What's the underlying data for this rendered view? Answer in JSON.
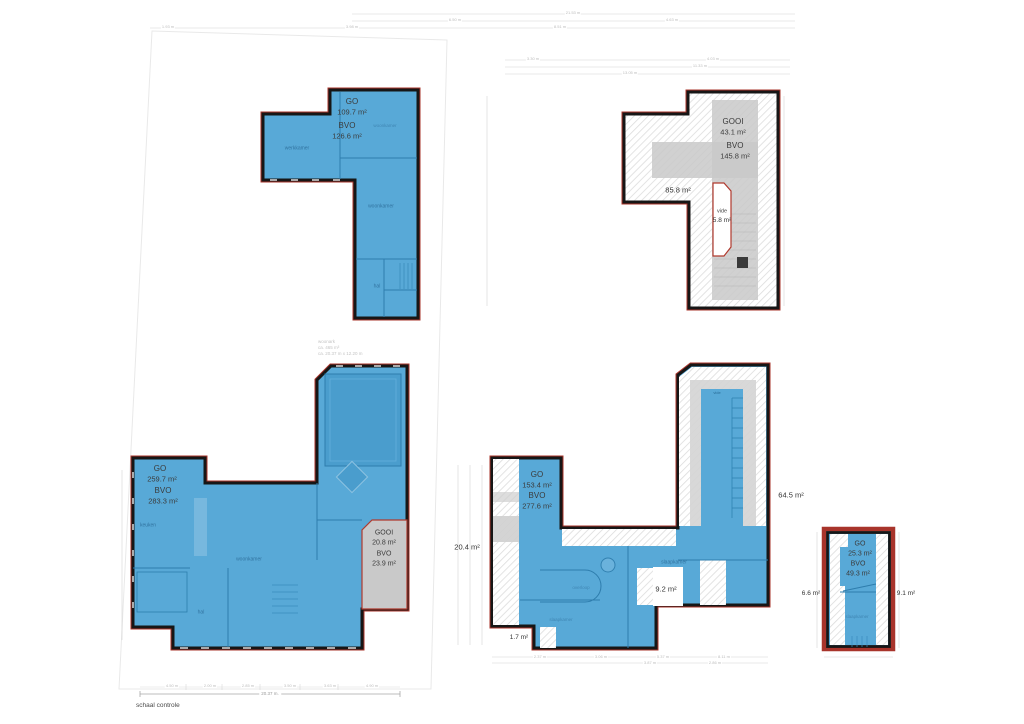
{
  "plans": {
    "p1": {
      "go_label": "GO",
      "go": "109.7 m²",
      "bvo_label": "BVO",
      "bvo": "126.6 m²",
      "rooms": {
        "werkkamer": "werkkamer",
        "woonkamer_top": "woonkamer",
        "woonkamer": "woonkamer",
        "hal": "hal"
      }
    },
    "p2": {
      "gooi_label": "GOOI",
      "gooi": "43.1 m²",
      "bvo_label": "BVO",
      "bvo": "145.8 m²",
      "area": "85.8 m²",
      "vide_label": "vide",
      "vide": "5.8 m²"
    },
    "p3": {
      "go_label": "GO",
      "go": "259.7 m²",
      "bvo_label": "BVO",
      "bvo": "283.3 m²",
      "gooi_label": "GOOI",
      "gooi": "20.8 m²",
      "gooi_bvo_label": "BVO",
      "gooi_bvo": "23.9 m²",
      "rooms": {
        "keuken": "keuken",
        "woonkamer": "woonkamer",
        "hal": "hal"
      },
      "notes": {
        "l1": "woonark",
        "l2": "ca. 465 m³",
        "l3": "ca. 20.37 m x 12.20 m"
      }
    },
    "p4": {
      "go_label": "GO",
      "go": "153.4 m²",
      "bvo_label": "BVO",
      "bvo": "277.6 m²",
      "area_left": "20.4 m²",
      "area_right": "64.5 m²",
      "area_notch": "9.2 m²",
      "area_bottom": "1.7 m²",
      "rooms": {
        "slaapkamer_r": "slaapkamer",
        "overloop": "overloop",
        "slaapkamer_l": "slaapkamer",
        "vide": "vide"
      }
    },
    "p5": {
      "go_label": "GO",
      "go": "25.3 m²",
      "bvo_label": "BVO",
      "bvo": "49.3 m²",
      "area_left": "6.6 m²",
      "area_right": "9.1 m²",
      "room": "slaapkamer"
    }
  },
  "dims": {
    "d0": "21.53 m",
    "d1": "6.50 m",
    "d2": "4.63 m",
    "d3": "1.93 m",
    "d4": "3.98 m",
    "d5": "8.51 m",
    "d6": "3.30 m",
    "d7": "4.03 m",
    "d8": "11.33 m",
    "d9": "13.05 m",
    "d10": "2.37 m",
    "d11": "3.06 m",
    "d12": "5.37 m",
    "d13": "8.11 m",
    "d14": "3.87 m",
    "d15": "2.86 m"
  },
  "scale": {
    "label": "schaal controle",
    "total": "20.37 m.",
    "segments": [
      "4.50 m",
      "2.00 m",
      "2.85 m",
      "3.50 m",
      "3.63 m",
      "4.90 m"
    ]
  },
  "colors": {
    "floor_fill": "#58a9d7",
    "wall": "#161616",
    "outline_red": "#a8342b",
    "gooi_gray": "#c9c9c9",
    "interior_line": "#2e7dad"
  }
}
